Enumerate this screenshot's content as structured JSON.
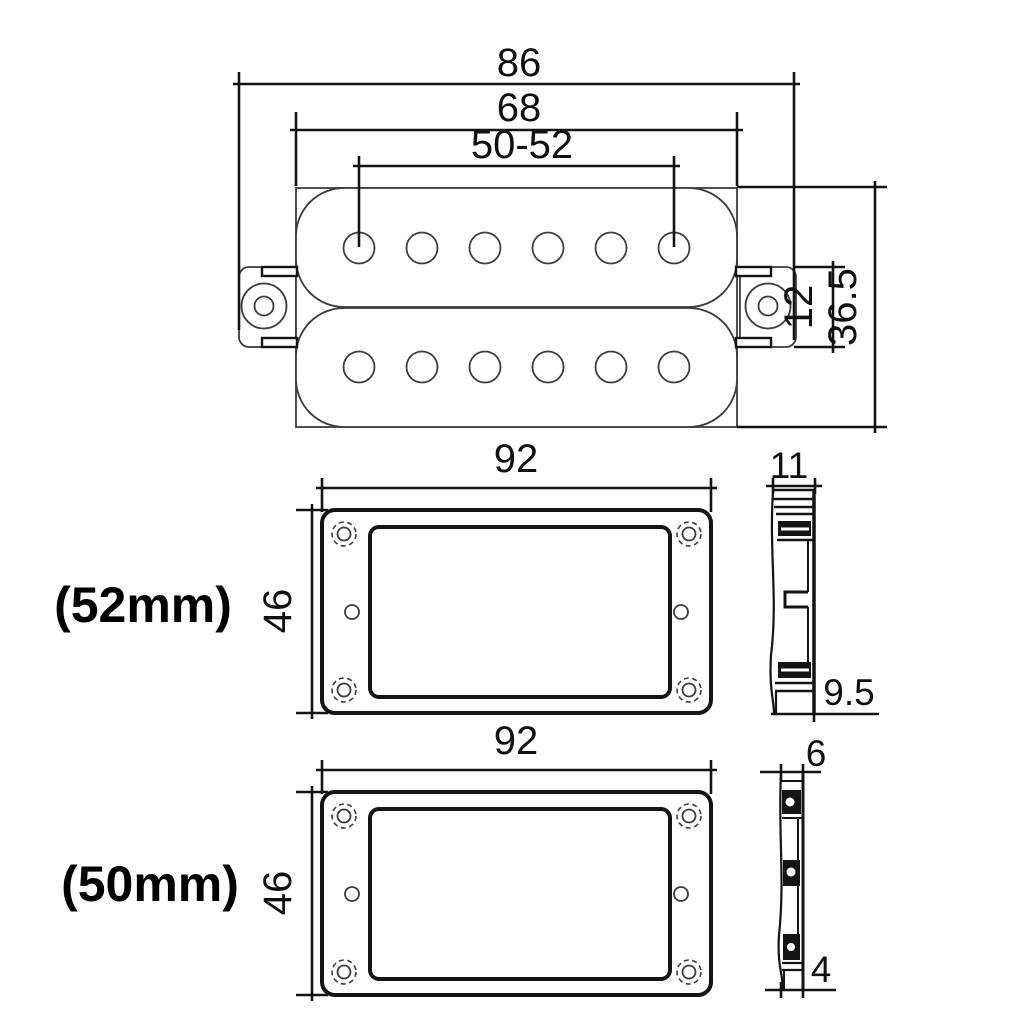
{
  "drawing": {
    "top_view": {
      "dim_overall_width": "86",
      "dim_body_width": "68",
      "dim_pole_spread": "50-52",
      "dim_tab_height": "12",
      "dim_overall_height": "36.5"
    },
    "ring_52": {
      "label": "(52mm)",
      "dim_width": "92",
      "dim_height": "46",
      "dim_side_top": "11",
      "dim_side_bottom": "9.5"
    },
    "ring_50": {
      "label": "(50mm)",
      "dim_width": "92",
      "dim_height": "46",
      "dim_side_top": "6",
      "dim_side_bottom": "4"
    }
  },
  "colors": {
    "line": "#141414",
    "outline": "#3c3c3c",
    "bg": "#ffffff"
  }
}
